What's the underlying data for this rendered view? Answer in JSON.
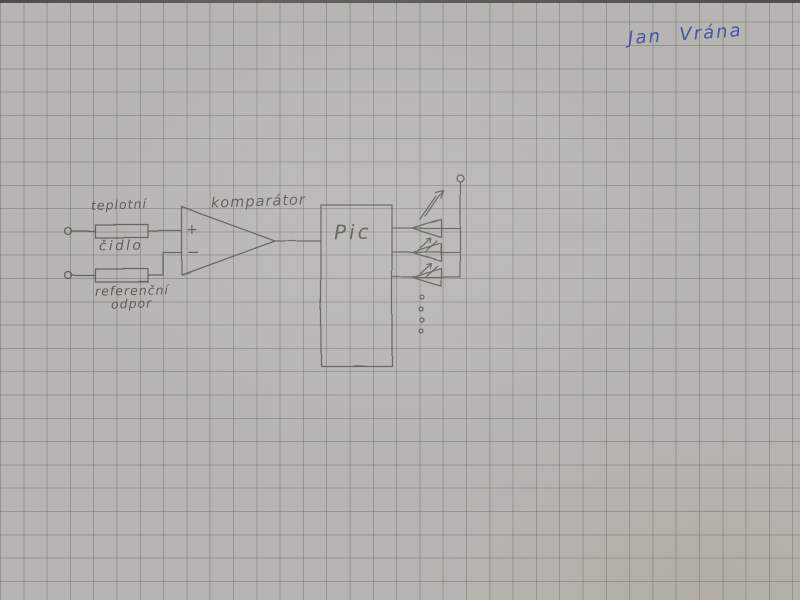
{
  "colors": {
    "paper": "#b6b5b1",
    "grid_line": "#90928c",
    "pencil": "#55534d",
    "ink_blue": "#3f4ea3",
    "photo_edge": "#44443f"
  },
  "signature": {
    "name": "Jan Vrána"
  },
  "schematic": {
    "sensor_resistor": {
      "label_line1": "teplotní",
      "label_line2": "čidlo"
    },
    "reference_resistor": {
      "label_line1": "referenční",
      "label_line2": "odpor"
    },
    "comparator": {
      "label": "komparátor",
      "input_plus": "+",
      "input_minus": "−"
    },
    "microcontroller": {
      "label": "Pic"
    }
  }
}
